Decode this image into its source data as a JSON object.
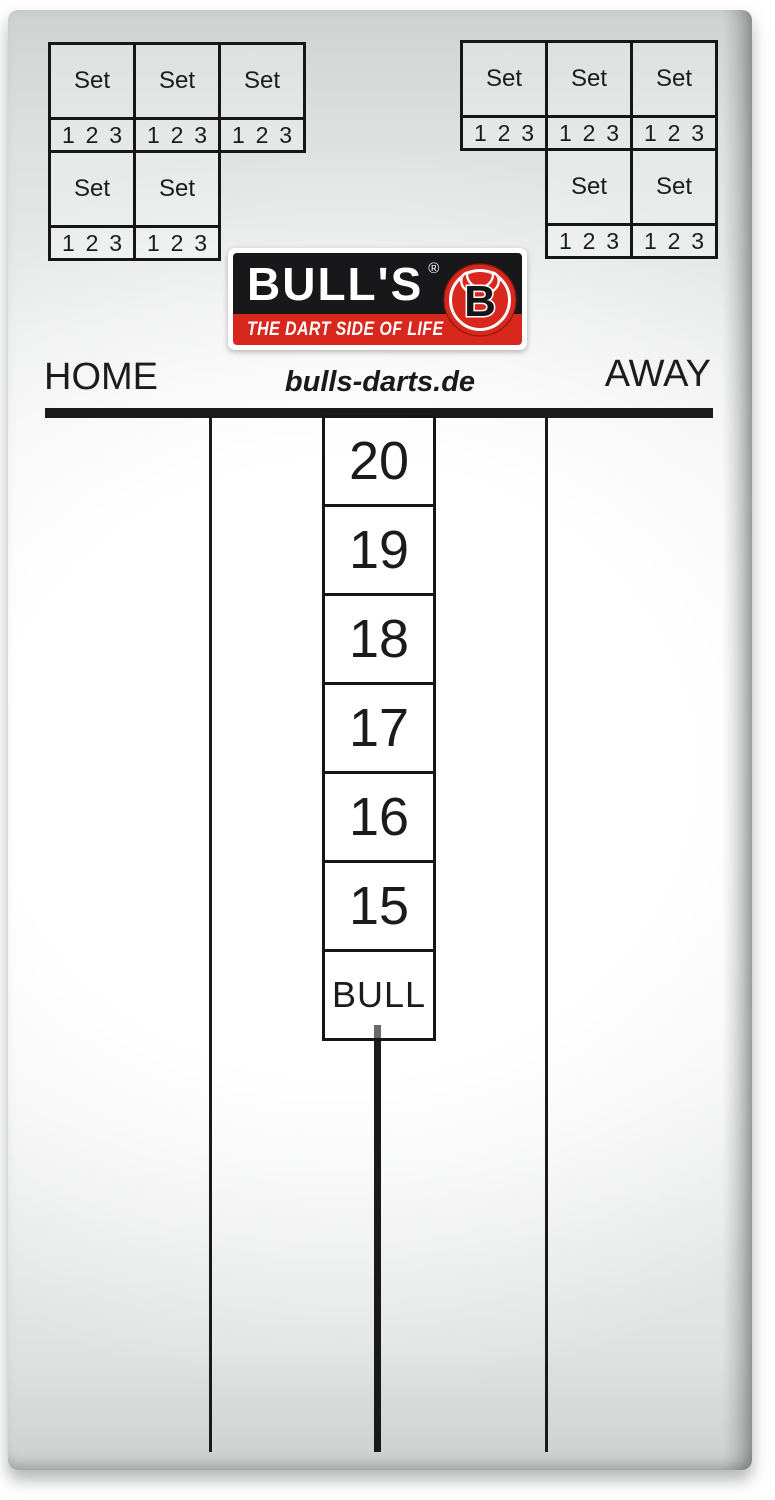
{
  "labels": {
    "set": "Set",
    "legs": [
      "1",
      "2",
      "3"
    ],
    "home": "HOME",
    "away": "AWAY",
    "website": "bulls-darts.de"
  },
  "logo": {
    "brand": "BULL'S",
    "registered_mark": "®",
    "tagline": "THE DART SIDE OF LIFE",
    "emblem_letter": "B",
    "colors": {
      "red": "#d8271d",
      "black": "#18181a",
      "white": "#ffffff"
    }
  },
  "score_column": {
    "targets": [
      "20",
      "19",
      "18",
      "17",
      "16",
      "15",
      "BULL"
    ]
  },
  "set_grids": {
    "left": {
      "row1_cells": 3,
      "row2_cells": 2,
      "row2_align": "left"
    },
    "right": {
      "row1_cells": 3,
      "row2_cells": 2,
      "row2_align": "right"
    }
  },
  "line_color": "#1a1a1a"
}
